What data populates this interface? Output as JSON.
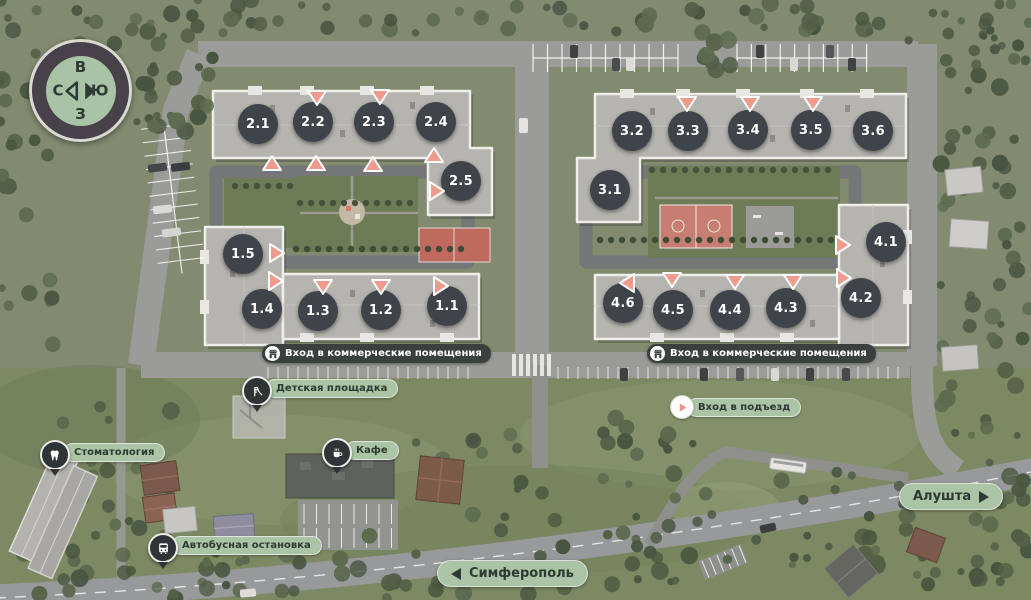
{
  "compass": {
    "top": "В",
    "right": "Ю",
    "bottom": "З",
    "left": "С"
  },
  "buildings": [
    {
      "id": "2.1",
      "x": 258,
      "y": 124
    },
    {
      "id": "2.2",
      "x": 313,
      "y": 122
    },
    {
      "id": "2.3",
      "x": 374,
      "y": 122
    },
    {
      "id": "2.4",
      "x": 436,
      "y": 122
    },
    {
      "id": "2.5",
      "x": 461,
      "y": 181
    },
    {
      "id": "3.1",
      "x": 610,
      "y": 190
    },
    {
      "id": "3.2",
      "x": 632,
      "y": 131
    },
    {
      "id": "3.3",
      "x": 688,
      "y": 131
    },
    {
      "id": "3.4",
      "x": 748,
      "y": 130
    },
    {
      "id": "3.5",
      "x": 811,
      "y": 130
    },
    {
      "id": "3.6",
      "x": 873,
      "y": 131
    },
    {
      "id": "1.5",
      "x": 243,
      "y": 254
    },
    {
      "id": "1.4",
      "x": 262,
      "y": 309
    },
    {
      "id": "1.3",
      "x": 318,
      "y": 311
    },
    {
      "id": "1.2",
      "x": 381,
      "y": 310
    },
    {
      "id": "1.1",
      "x": 447,
      "y": 306
    },
    {
      "id": "4.1",
      "x": 886,
      "y": 242
    },
    {
      "id": "4.2",
      "x": 861,
      "y": 298
    },
    {
      "id": "4.3",
      "x": 786,
      "y": 308
    },
    {
      "id": "4.4",
      "x": 730,
      "y": 310
    },
    {
      "id": "4.5",
      "x": 673,
      "y": 310
    },
    {
      "id": "4.6",
      "x": 623,
      "y": 303
    }
  ],
  "entrances": [
    {
      "x": 317,
      "y": 98,
      "dir": "down"
    },
    {
      "x": 380,
      "y": 97,
      "dir": "down"
    },
    {
      "x": 272,
      "y": 163,
      "dir": "up"
    },
    {
      "x": 316,
      "y": 163,
      "dir": "up"
    },
    {
      "x": 373,
      "y": 164,
      "dir": "up"
    },
    {
      "x": 434,
      "y": 155,
      "dir": "up"
    },
    {
      "x": 437,
      "y": 191,
      "dir": "right"
    },
    {
      "x": 687,
      "y": 104,
      "dir": "down"
    },
    {
      "x": 750,
      "y": 104,
      "dir": "down"
    },
    {
      "x": 813,
      "y": 104,
      "dir": "down"
    },
    {
      "x": 277,
      "y": 253,
      "dir": "right"
    },
    {
      "x": 276,
      "y": 281,
      "dir": "right"
    },
    {
      "x": 323,
      "y": 287,
      "dir": "down"
    },
    {
      "x": 381,
      "y": 287,
      "dir": "down"
    },
    {
      "x": 441,
      "y": 286,
      "dir": "right"
    },
    {
      "x": 627,
      "y": 283,
      "dir": "left"
    },
    {
      "x": 672,
      "y": 280,
      "dir": "down"
    },
    {
      "x": 735,
      "y": 282,
      "dir": "down"
    },
    {
      "x": 793,
      "y": 282,
      "dir": "down"
    },
    {
      "x": 843,
      "y": 245,
      "dir": "right"
    },
    {
      "x": 844,
      "y": 278,
      "dir": "right"
    }
  ],
  "commercial_entrances": [
    {
      "label": "Вход в коммерческие помещения",
      "icon": "storefront-icon",
      "x": 262,
      "y": 344
    },
    {
      "label": "Вход в коммерческие помещения",
      "icon": "storefront-icon",
      "x": 647,
      "y": 344
    }
  ],
  "pois": [
    {
      "type": "pin",
      "label": "Детская площадка",
      "icon": "slide-icon",
      "x": 242,
      "y": 376
    },
    {
      "type": "pin",
      "label": "Стоматология",
      "icon": "tooth-icon",
      "x": 40,
      "y": 440
    },
    {
      "type": "pin",
      "label": "Кафе",
      "icon": "coffee-cup-icon",
      "x": 322,
      "y": 438
    },
    {
      "type": "pin",
      "label": "Автобусная остановка",
      "icon": "bus-icon",
      "x": 148,
      "y": 533
    },
    {
      "type": "badge",
      "label": "Вход в подъезд",
      "icon": "entrance-triangle-icon",
      "x": 670,
      "y": 395
    }
  ],
  "road_signs": [
    {
      "label": "Симферополь",
      "arrow": "left",
      "x": 437,
      "y": 560
    },
    {
      "label": "Алушта",
      "arrow": "right",
      "x": 899,
      "y": 483
    }
  ],
  "colors": {
    "entrance_pink": "#ee9b8e",
    "marker_dark": "#3f444a",
    "pill_green": "#abc4a6",
    "pill_dark": "#3a403d",
    "pin_dark": "#2f3537"
  }
}
